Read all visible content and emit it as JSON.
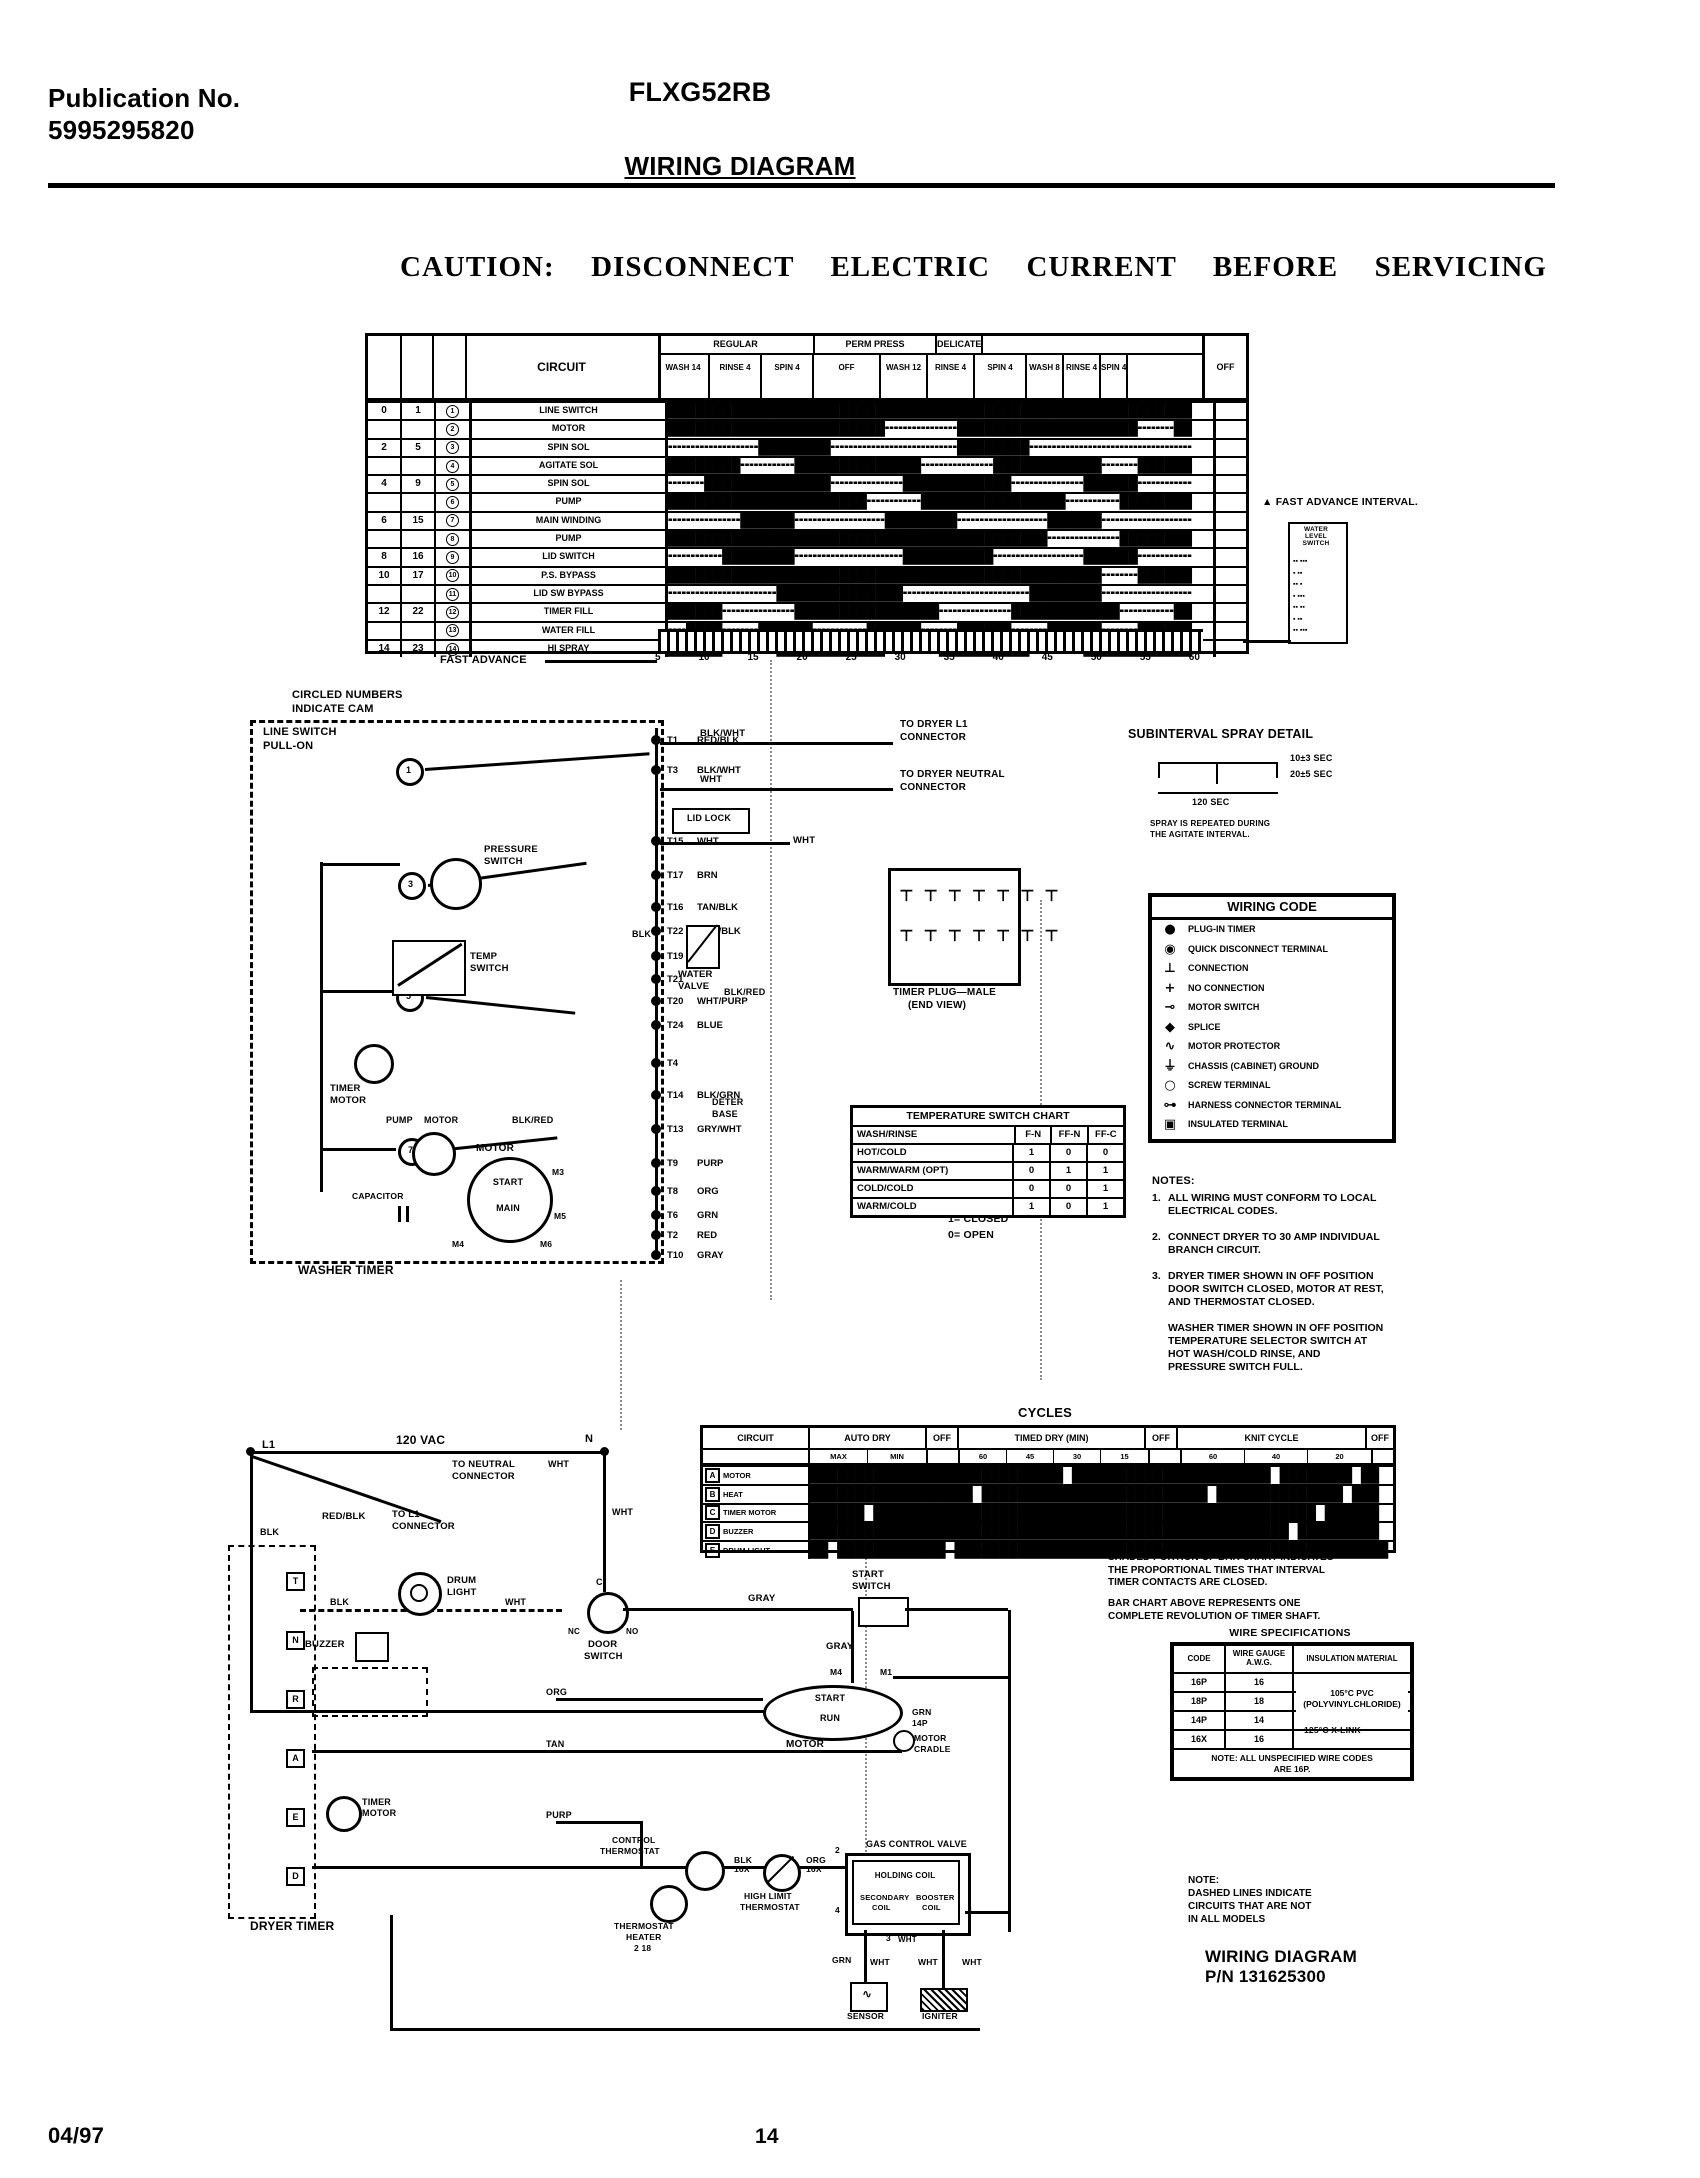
{
  "page": {
    "pub_label": "Publication No.",
    "pub_no": "5995295820",
    "model": "FLXG52RB",
    "title": "WIRING DIAGRAM",
    "caution": "CAUTION:  DISCONNECT  ELECTRIC  CURRENT  BEFORE  SERVICING",
    "footer_date": "04/97",
    "footer_page": "14"
  },
  "timing": {
    "circuit_header": "CIRCUIT",
    "groups": [
      "REGULAR",
      "PERM PRESS",
      "DELICATE"
    ],
    "subs": [
      "WASH\n14",
      "RINSE\n4",
      "SPIN\n4",
      "OFF",
      "WASH\n12",
      "RINSE\n4",
      "SPIN\n4",
      "WASH\n8",
      "RINSE\n4",
      "SPIN\n4"
    ],
    "off_label": "OFF",
    "rows": [
      {
        "n1": "0",
        "n2": "1",
        "cam": "1",
        "label": "LINE SWITCH",
        "bar": "██████████████████████████████████████████████████████████"
      },
      {
        "n1": "",
        "n2": "",
        "cam": "2",
        "label": "MOTOR",
        "bar": "████████████████████████╍╍╍╍╍╍╍╍████████████████████╍╍╍╍██"
      },
      {
        "n1": "2",
        "n2": "5",
        "cam": "3",
        "label": "SPIN SOL",
        "bar": "╍╍╍╍╍╍╍╍╍╍████████╍╍╍╍╍╍╍╍╍╍╍╍╍╍████████╍╍╍╍╍╍╍╍╍╍╍╍╍╍╍╍╍╍"
      },
      {
        "n1": "",
        "n2": "",
        "cam": "4",
        "label": "AGITATE SOL",
        "bar": "████████╍╍╍╍╍╍██████████████╍╍╍╍╍╍╍╍████████████╍╍╍╍██████"
      },
      {
        "n1": "4",
        "n2": "9",
        "cam": "5",
        "label": "SPIN SOL",
        "bar": "╍╍╍╍██████████████╍╍╍╍╍╍╍╍████████████╍╍╍╍╍╍╍╍██████╍╍╍╍╍╍"
      },
      {
        "n1": "",
        "n2": "",
        "cam": "6",
        "label": "PUMP",
        "bar": "██████████████████████╍╍╍╍╍╍████████████████╍╍╍╍╍╍████████"
      },
      {
        "n1": "6",
        "n2": "15",
        "cam": "7",
        "label": "MAIN WINDING",
        "bar": "╍╍╍╍╍╍╍╍██████╍╍╍╍╍╍╍╍╍╍████████╍╍╍╍╍╍╍╍╍╍██████╍╍╍╍╍╍╍╍╍╍"
      },
      {
        "n1": "",
        "n2": "",
        "cam": "8",
        "label": "PUMP",
        "bar": "██████████████████████████████████████████╍╍╍╍╍╍╍╍████████"
      },
      {
        "n1": "8",
        "n2": "16",
        "cam": "9",
        "label": "LID SWITCH",
        "bar": "╍╍╍╍╍╍████████╍╍╍╍╍╍╍╍╍╍╍╍██████████╍╍╍╍╍╍╍╍╍╍██████╍╍╍╍╍╍"
      },
      {
        "n1": "10",
        "n2": "17",
        "cam": "10",
        "label": "P.S. BYPASS",
        "bar": "████████████████████████████████████████████████╍╍╍╍██████"
      },
      {
        "n1": "",
        "n2": "",
        "cam": "11",
        "label": "LID SW BYPASS",
        "bar": "╍╍╍╍╍╍╍╍╍╍╍╍██████████████╍╍╍╍╍╍╍╍╍╍╍╍╍╍████████╍╍╍╍╍╍╍╍╍╍"
      },
      {
        "n1": "12",
        "n2": "22",
        "cam": "12",
        "label": "TIMER FILL",
        "bar": "██████╍╍╍╍╍╍╍╍████████████████╍╍╍╍╍╍╍╍████████████╍╍╍╍╍╍██"
      },
      {
        "n1": "",
        "n2": "",
        "cam": "13",
        "label": "WATER FILL",
        "bar": "╍╍████╍╍╍╍██████╍╍╍╍╍╍██████╍╍╍╍██████╍╍╍╍██████╍╍╍╍██████"
      },
      {
        "n1": "14",
        "n2": "23",
        "cam": "14",
        "label": "HI SPRAY",
        "bar": "██████╍╍╍╍╍╍████████████╍╍╍╍╍╍██████████╍╍╍╍╍╍████████████"
      }
    ],
    "scale": [
      "5",
      "10",
      "15",
      "20",
      "25",
      "30",
      "35",
      "40",
      "45",
      "50",
      "55",
      "60"
    ],
    "fast_advance": "FAST ADVANCE",
    "triangle_note": "▲ FAST ADVANCE INTERVAL.",
    "side_box": {
      "title": "WATER\nLEVEL\nSWITCH",
      "rows": [
        "▪▪ ▪▪▪",
        "▪ ▪▪",
        "▪▪ ▪",
        "▪ ▪▪▪",
        "▪▪ ▪▪",
        "▪ ▪▪",
        "▪▪ ▪▪▪"
      ]
    }
  },
  "washer": {
    "cam_note_1": "CIRCLED NUMBERS",
    "cam_note_2": "INDICATE CAM",
    "line_switch_1": "LINE SWITCH",
    "line_switch_2": "PULL-ON",
    "timer_label": "WASHER TIMER",
    "cam_numbers": [
      "1",
      "3",
      "5",
      "7"
    ],
    "terminals": [
      {
        "id": "T1",
        "color": "RED/BLK"
      },
      {
        "id": "T3",
        "color": "BLK/WHT"
      },
      {
        "id": "T15",
        "color": "WHT"
      },
      {
        "id": "T17",
        "color": "BRN"
      },
      {
        "id": "T16",
        "color": "TAN/BLK"
      },
      {
        "id": "T22",
        "color": "WHT/BLK"
      },
      {
        "id": "T19",
        "color": "PINK"
      },
      {
        "id": "T21",
        "color": ""
      },
      {
        "id": "T20",
        "color": "WHT/PURP"
      },
      {
        "id": "T24",
        "color": "BLUE"
      },
      {
        "id": "T4",
        "color": ""
      },
      {
        "id": "T14",
        "color": "BLK/GRN"
      },
      {
        "id": "T13",
        "color": "GRY/WHT"
      },
      {
        "id": "T9",
        "color": "PURP"
      },
      {
        "id": "T8",
        "color": "ORG"
      },
      {
        "id": "T6",
        "color": "GRN"
      },
      {
        "id": "T2",
        "color": "RED"
      },
      {
        "id": "T10",
        "color": "GRAY"
      }
    ],
    "to_dryer_l1_1": "TO DRYER L1",
    "to_dryer_l1_2": "CONNECTOR",
    "to_dryer_n_1": "TO DRYER NEUTRAL",
    "to_dryer_n_2": "CONNECTOR",
    "lid_lock": "LID LOCK",
    "wire_blkwht": "BLK/WHT",
    "wire_wht_a": "WHT",
    "wire_wht_b": "WHT",
    "pressure_switch_1": "PRESSURE",
    "pressure_switch_2": "SWITCH",
    "temp_switch_1": "TEMP",
    "temp_switch_2": "SWITCH",
    "timer_motor_1": "TIMER",
    "timer_motor_2": "MOTOR",
    "water_valve_1": "WATER",
    "water_valve_2": "VALVE",
    "plug_label_1": "TIMER PLUG—MALE",
    "plug_label_2": "(END VIEW)",
    "plug_pins_top": "⊤ ⊤ ⊤ ⊤ ⊤ ⊤ ⊤",
    "plug_pins_bottom": "⊤ ⊤ ⊤ ⊤ ⊤ ⊤ ⊤",
    "pump_motor_1": "PUMP",
    "pump_motor_2": "MOTOR",
    "motor_label": "MOTOR",
    "motor_start": "START",
    "motor_main": "MAIN",
    "m3": "M3",
    "m5": "M5",
    "m4": "M4",
    "m6": "M6",
    "capacitor": "CAPACITOR",
    "deter_1": "DETER",
    "deter_2": "BASE",
    "wire_blkred_a": "BLK/RED",
    "wire_blkred_b": "BLK/RED",
    "wire_blk": "BLK"
  },
  "spray": {
    "title": "SUBINTERVAL SPRAY DETAIL",
    "t1": "10±3 SEC",
    "t2": "20±5 SEC",
    "t3": "120 SEC",
    "note_1": "SPRAY IS REPEATED DURING",
    "note_2": "THE AGITATE INTERVAL."
  },
  "wiring_code": {
    "title": "WIRING CODE",
    "entries": [
      {
        "sym": "●",
        "label": "PLUG-IN TIMER"
      },
      {
        "sym": "◉",
        "label": "QUICK DISCONNECT TERMINAL"
      },
      {
        "sym": "⊥",
        "label": "CONNECTION"
      },
      {
        "sym": "+",
        "label": "NO CONNECTION"
      },
      {
        "sym": "⊸",
        "label": "MOTOR SWITCH"
      },
      {
        "sym": "◆",
        "label": "SPLICE"
      },
      {
        "sym": "∿",
        "label": "MOTOR PROTECTOR"
      },
      {
        "sym": "⏚",
        "label": "CHASSIS (CABINET) GROUND"
      },
      {
        "sym": "○",
        "label": "SCREW TERMINAL"
      },
      {
        "sym": "⊶",
        "label": "HARNESS CONNECTOR TERMINAL"
      },
      {
        "sym": "▣",
        "label": "INSULATED TERMINAL"
      }
    ]
  },
  "temp_chart": {
    "title": "TEMPERATURE SWITCH CHART",
    "col_label": "WASH/RINSE",
    "cols": [
      "F-N",
      "FF-N",
      "FF-C"
    ],
    "rows": [
      {
        "label": "HOT/COLD",
        "v": [
          "1",
          "0",
          "0"
        ]
      },
      {
        "label": "WARM/WARM (OPT)",
        "v": [
          "0",
          "1",
          "1"
        ]
      },
      {
        "label": "COLD/COLD",
        "v": [
          "0",
          "0",
          "1"
        ]
      },
      {
        "label": "WARM/COLD",
        "v": [
          "1",
          "0",
          "1"
        ]
      }
    ],
    "closed": "1= CLOSED",
    "open": "0= OPEN"
  },
  "notes": {
    "heading": "NOTES:",
    "items": [
      {
        "num": "1.",
        "lines": [
          "ALL WIRING MUST CONFORM TO LOCAL",
          "ELECTRICAL CODES."
        ]
      },
      {
        "num": "2.",
        "lines": [
          "CONNECT DRYER TO 30 AMP INDIVIDUAL",
          "BRANCH CIRCUIT."
        ]
      },
      {
        "num": "3.",
        "lines": [
          "DRYER TIMER SHOWN IN OFF POSITION",
          "DOOR SWITCH CLOSED, MOTOR AT REST,",
          "AND THERMOSTAT CLOSED."
        ]
      },
      {
        "num": "",
        "lines": [
          "WASHER TIMER SHOWN IN OFF POSITION",
          "TEMPERATURE SELECTOR SWITCH AT",
          "HOT WASH/COLD RINSE, AND",
          "PRESSURE SWITCH FULL."
        ]
      }
    ]
  },
  "cycles": {
    "title": "CYCLES",
    "h_circuit": "CIRCUIT",
    "h_auto": "AUTO DRY",
    "h_off1": "OFF",
    "h_timed": "TIMED DRY (MIN)",
    "h_off2": "OFF",
    "h_knit": "KNIT CYCLE",
    "h_off3": "OFF",
    "auto_subs": [
      "MAX",
      "MIN"
    ],
    "timed_subs": [
      "60",
      "45",
      "30",
      "15"
    ],
    "knit_subs": [
      "60",
      "40",
      "20"
    ],
    "rows": [
      {
        "t": "A",
        "label": "MOTOR",
        "bar": "████████████████████████████ ██████████████████████ ████████ ██"
      },
      {
        "t": "B",
        "label": "HEAT",
        "bar": "██████████████████ █████████████████████████ ██████████████ ███"
      },
      {
        "t": "C",
        "label": "TIMER MOTOR",
        "bar": "██████ █████████████████████████████████████████████████ ██████"
      },
      {
        "t": "D",
        "label": "BUZZER",
        "bar": "█████████████████████████████████████████████████████ █████████"
      },
      {
        "t": "E",
        "label": "DRUM LIGHT",
        "bar": "██ ████████████ ████████████████████████████████████████████████"
      }
    ],
    "note1": [
      "SHADED PORTION OF BAR CHART INDICATES",
      "THE PROPORTIONAL TIMES THAT INTERVAL",
      "TIMER CONTACTS ARE CLOSED."
    ],
    "note2": [
      "BAR CHART ABOVE REPRESENTS ONE",
      "COMPLETE REVOLUTION OF TIMER SHAFT."
    ]
  },
  "wire_specs": {
    "title": "WIRE SPECIFICATIONS",
    "col1": "CODE",
    "col2": "WIRE GAUGE\nA.W.G.",
    "col3": "INSULATION MATERIAL",
    "rows": [
      {
        "code": "16P",
        "gauge": "16"
      },
      {
        "code": "18P",
        "gauge": "18"
      },
      {
        "code": "14P",
        "gauge": "14"
      },
      {
        "code": "16X",
        "gauge": "16"
      }
    ],
    "mat1_1": "105°C PVC",
    "mat1_2": "(POLYVINYLCHLORIDE)",
    "mat2": "125°C X-LINK",
    "note_1": "NOTE: ALL UNSPECIFIED WIRE CODES",
    "note_2": "ARE 16P."
  },
  "dryer": {
    "vac": "120 VAC",
    "l1": "L1",
    "n": "N",
    "to_neutral_1": "TO NEUTRAL",
    "to_neutral_2": "CONNECTOR",
    "redblk": "RED/BLK",
    "to_l1_1": "TO L1",
    "to_l1_2": "CONNECTOR",
    "blk_a": "BLK",
    "blk_b": "BLK",
    "blk_c": "BLK",
    "wht_a": "WHT",
    "wht_b": "WHT",
    "wht_c": "WHT",
    "drum_light_1": "DRUM",
    "drum_light_2": "LIGHT",
    "buzzer": "BUZZER",
    "door_c": "C",
    "door_nc": "NC",
    "door_no": "NO",
    "door_switch_1": "DOOR",
    "door_switch_2": "SWITCH",
    "gray_a": "GRAY",
    "gray_b": "GRAY",
    "start_switch_1": "START",
    "start_switch_2": "SWITCH",
    "m4": "M4",
    "m1": "M1",
    "motor_start": "START",
    "motor_run": "RUN",
    "motor": "MOTOR",
    "org": "ORG",
    "tan": "TAN",
    "purp": "PURP",
    "grn": "GRN",
    "p14": "14P",
    "cradle_1": "MOTOR",
    "cradle_2": "CRADLE",
    "timer_motor_1": "TIMER",
    "timer_motor_2": "MOTOR",
    "dryer_timer": "DRYER TIMER",
    "timer_terms": [
      "T",
      "N",
      "R",
      "A",
      "E",
      "D"
    ],
    "ctl_thermo_1": "CONTROL",
    "ctl_thermo_2": "THERMOSTAT",
    "blk16x": "BLK\n16X",
    "hl_1": "HIGH LIMIT",
    "hl_2": "THERMOSTAT",
    "org16x": "ORG\n16X",
    "heater_1": "THERMOSTAT",
    "heater_2": "HEATER",
    "heater_3": "2 18",
    "gas_valve": "GAS CONTROL VALVE",
    "holding": "HOLDING COIL",
    "secondary_1": "SECONDARY",
    "secondary_2": "COIL",
    "booster_1": "BOOSTER",
    "booster_2": "COIL",
    "v2": "2",
    "v4": "4",
    "v1": "1",
    "v3": "3",
    "vwht": "WHT",
    "grn_b": "GRN",
    "wht_d": "WHT",
    "wht_e": "WHT",
    "wht_f": "WHT",
    "sensor": "SENSOR",
    "igniter": "IGNITER",
    "note": [
      "NOTE:",
      "DASHED LINES INDICATE",
      "CIRCUITS THAT ARE NOT",
      "IN ALL MODELS"
    ],
    "pn_1": "WIRING DIAGRAM",
    "pn_2": "P/N 131625300"
  }
}
